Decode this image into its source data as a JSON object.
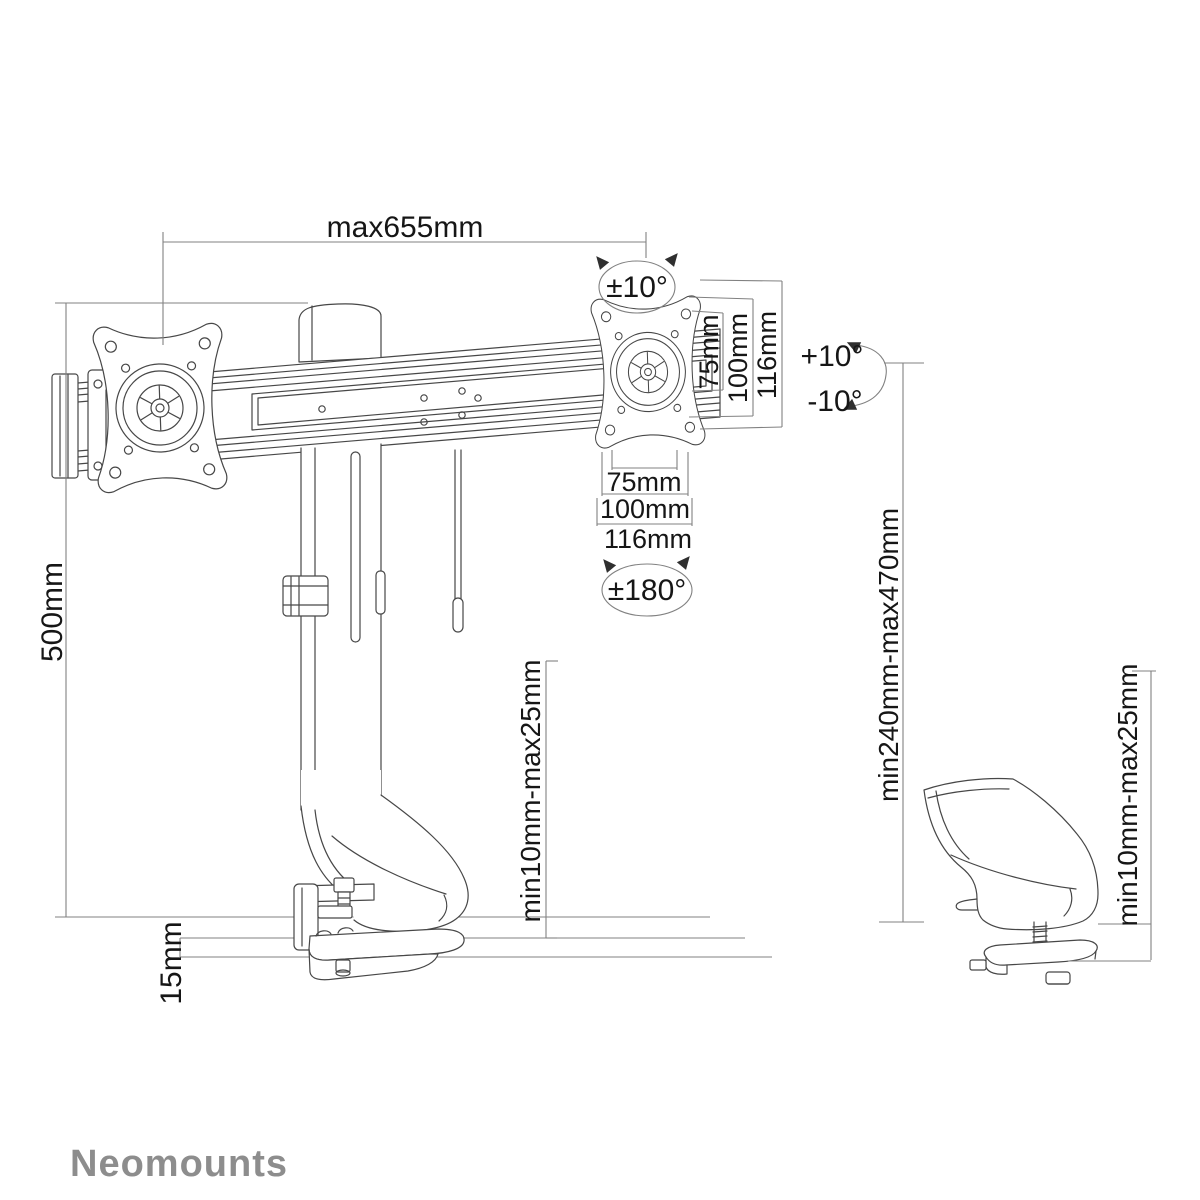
{
  "diagram": {
    "brand_logo": "Neomounts",
    "labels": {
      "max_width": "max655mm",
      "rotation": "±10°",
      "vesa_vertical": [
        "75mm",
        "100mm",
        "116mm"
      ],
      "tilt_up": "+10°",
      "tilt_down": "-10°",
      "vesa_horizontal": [
        "75mm",
        "100mm",
        "116mm"
      ],
      "swivel": "±180°",
      "pole_height": "500mm",
      "desk_clamp_range": "min10mm-max25mm",
      "height_range": "min240mm-max470mm",
      "desk_clamp_range_detail": "min10mm-max25mm",
      "base_plate_height": "15mm"
    },
    "colors": {
      "drawing_line": "#474747",
      "dimension_line": "#818181",
      "text": "#161616",
      "logo": "#8d8d8d",
      "background": "#ffffff"
    }
  }
}
